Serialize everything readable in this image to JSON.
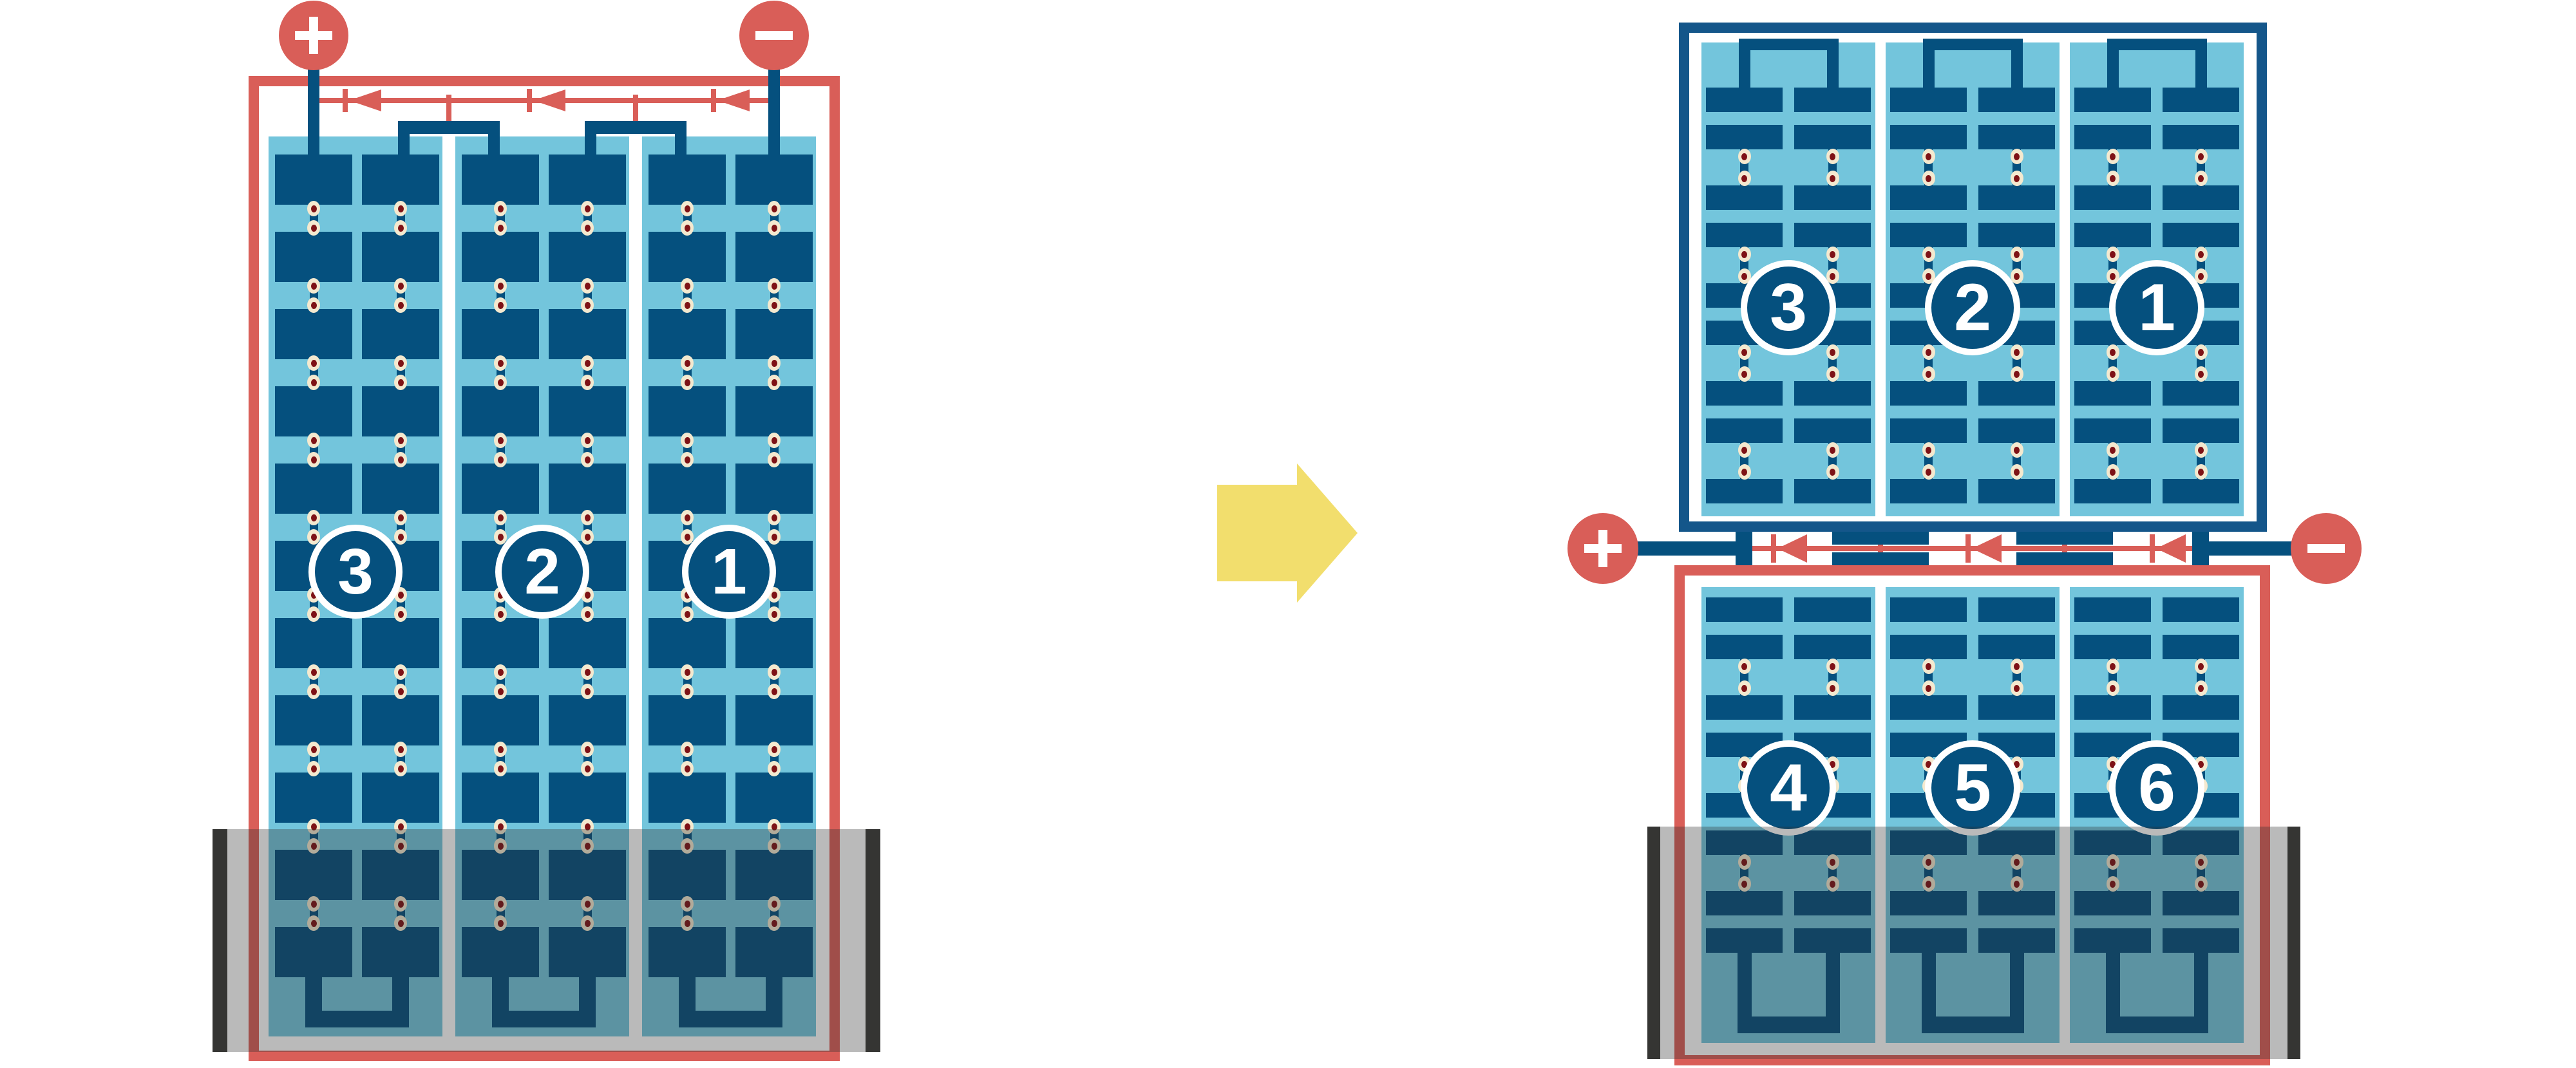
{
  "figure": {
    "description": "Battery plate-group connection diagram, before and after rearrangement",
    "background": "#FFFFFF"
  },
  "colors": {
    "plate_navy": "#05507E",
    "frame_navy": "#14568A",
    "light_blue": "#73C5DC",
    "red": "#D95E58",
    "cream_dot": "#F4E9CF",
    "dot_center_red": "#7E1216",
    "arrow_yellow": "#F2DE6D",
    "tray_bar_gray": "#3A3937",
    "tray_overlay": "rgba(45,45,45,0.33)"
  },
  "left_battery": {
    "terminal_positive": "+",
    "terminal_negative": "−",
    "cells": [
      {
        "label": "3"
      },
      {
        "label": "2"
      },
      {
        "label": "1"
      }
    ],
    "plate_columns_per_cell": 2,
    "plate_rows_per_column": 11,
    "current_direction": "left"
  },
  "right_battery": {
    "terminal_positive": "+",
    "terminal_negative": "−",
    "top_module": {
      "frame_color": "navy",
      "cells": [
        {
          "label": "3"
        },
        {
          "label": "2"
        },
        {
          "label": "1"
        }
      ]
    },
    "bottom_module": {
      "frame_color": "red",
      "cells": [
        {
          "label": "4"
        },
        {
          "label": "5"
        },
        {
          "label": "6"
        }
      ]
    },
    "current_direction": "left"
  },
  "transform_arrow": {
    "direction": "right"
  }
}
